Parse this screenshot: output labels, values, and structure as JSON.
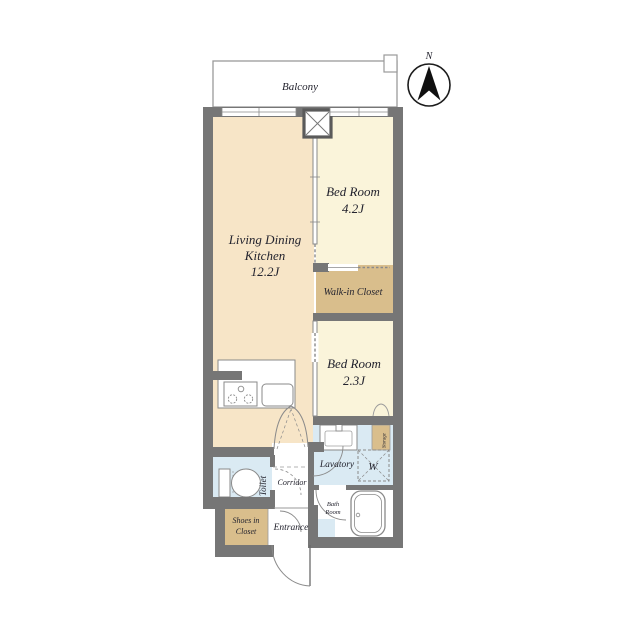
{
  "plan": {
    "balcony": {
      "label": "Balcony"
    },
    "compass": {
      "label": "N"
    },
    "rooms": {
      "ldk": {
        "line1": "Living Dining",
        "line2": "Kitchen",
        "size": "12.2J"
      },
      "bedroom1": {
        "name": "Bed Room",
        "size": "4.2J"
      },
      "bedroom2": {
        "name": "Bed Room",
        "size": "2.3J"
      },
      "walk_in_closet": {
        "label": "Walk-in Closet"
      },
      "lavatory": {
        "label": "Lavatory"
      },
      "washer": {
        "label": "W"
      },
      "bath_room": {
        "line1": "Bath",
        "line2": "Room"
      },
      "toilet": {
        "label": "Toilet"
      },
      "corridor": {
        "label": "Corridor"
      },
      "entrance": {
        "label": "Entrance"
      },
      "shoes_closet": {
        "line1": "Shoes in",
        "line2": "Closet"
      },
      "storage": {
        "label": "Storage"
      }
    },
    "colors": {
      "wall": "#767676",
      "ldk_floor": "#f7e5c7",
      "bedroom_floor": "#faf4da",
      "closet_floor": "#d9be8c",
      "wet_floor": "#daeaf3",
      "line": "#8a8a8a",
      "text": "#23232e"
    }
  }
}
